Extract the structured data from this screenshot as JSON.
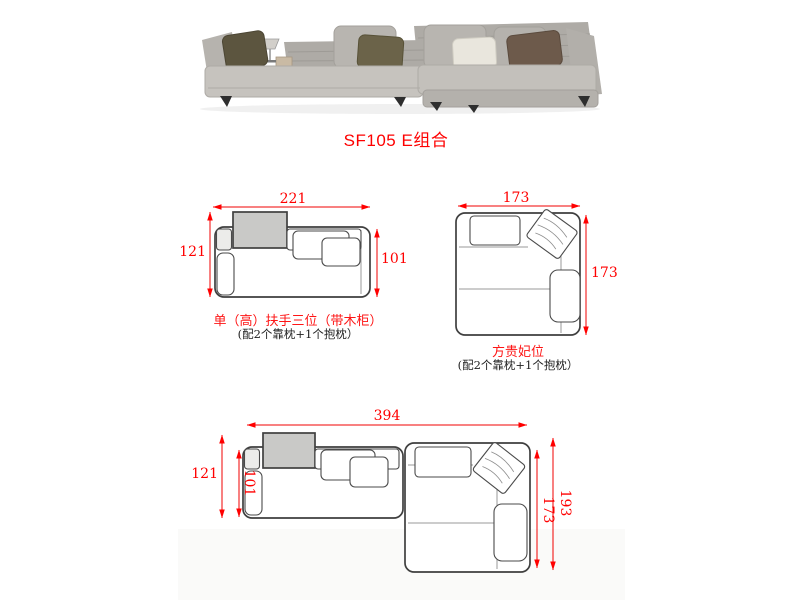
{
  "title": "SF105 E组合",
  "diagrams": {
    "single": {
      "label": "单（高）扶手三位（带木柜）",
      "note": "(配2个靠枕+1个抱枕）",
      "width": "221",
      "depth_total": "121",
      "depth_body": "101"
    },
    "chaise": {
      "label": "方贵妃位",
      "note": "(配2个靠枕+1个抱枕）",
      "width": "173",
      "depth": "173"
    },
    "combo": {
      "width": "394",
      "depth_left": "121",
      "depth_body": "101",
      "chaise_depth": "173",
      "depth_total": "193"
    }
  },
  "colors": {
    "dimension_red": "#ff0000",
    "outline_gray": "#3f3f3f",
    "cabinet_fill": "#c9c9c7",
    "sofa_fabric": "#b7b4af",
    "pillow_dark_olive": "#5c553f",
    "pillow_olive": "#6b6349",
    "pillow_cream": "#e9e6dd",
    "pillow_brown": "#6d5a4b"
  }
}
